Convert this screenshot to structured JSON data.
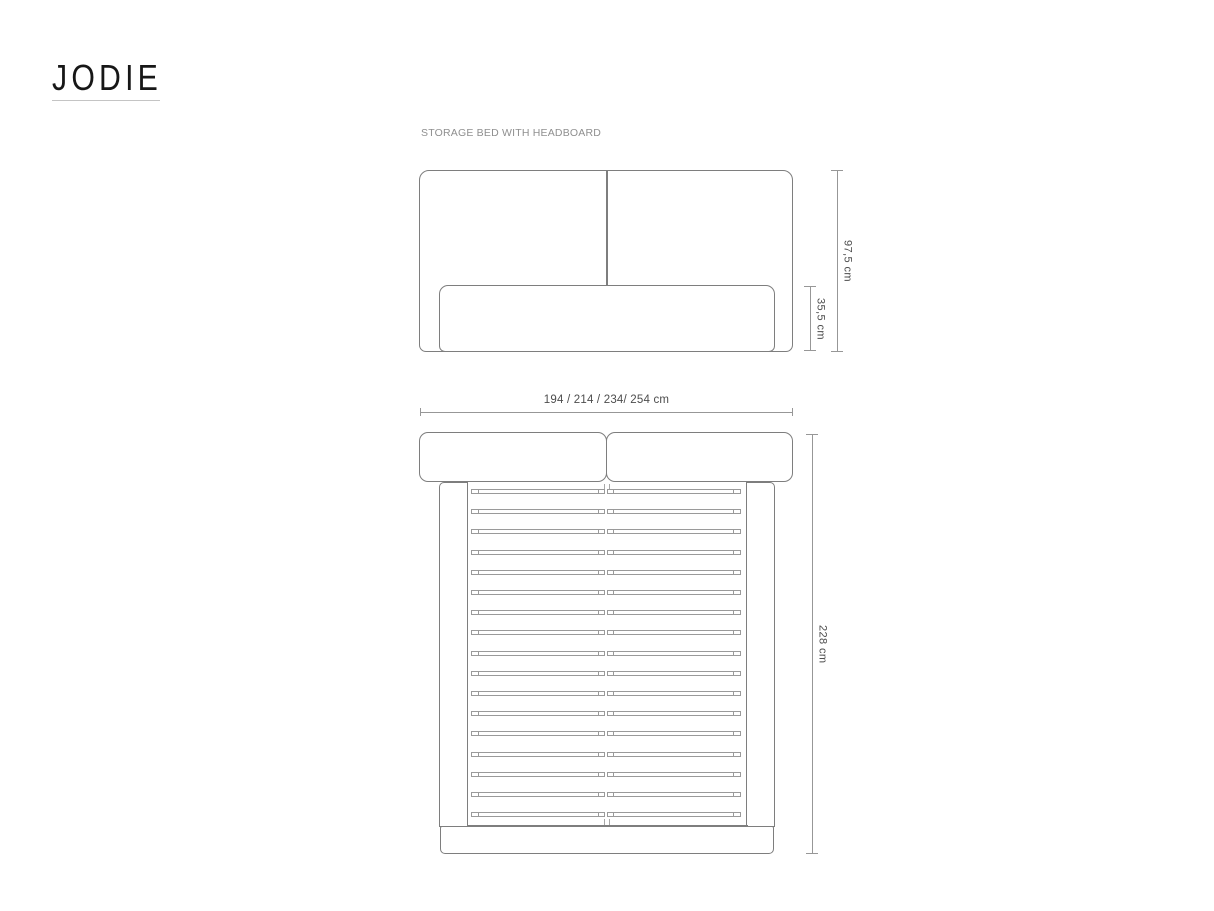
{
  "brand": {
    "logo_text": "JODIE"
  },
  "diagram": {
    "title": "STORAGE BED WITH HEADBOARD",
    "dimensions": {
      "headboard_height": "97,5 cm",
      "frame_height": "35,5 cm",
      "widths": "194 / 214 / 234/ 254 cm",
      "length": "228 cm"
    },
    "top_view": {
      "slat_count": 17
    },
    "colors": {
      "line": "#7e7e7e",
      "dim_line": "#979797",
      "slat_line": "#9a9a9a",
      "text": "#4d4d4d",
      "title_text": "#8f8f8f",
      "logo_text": "#171717",
      "background": "#ffffff"
    }
  }
}
